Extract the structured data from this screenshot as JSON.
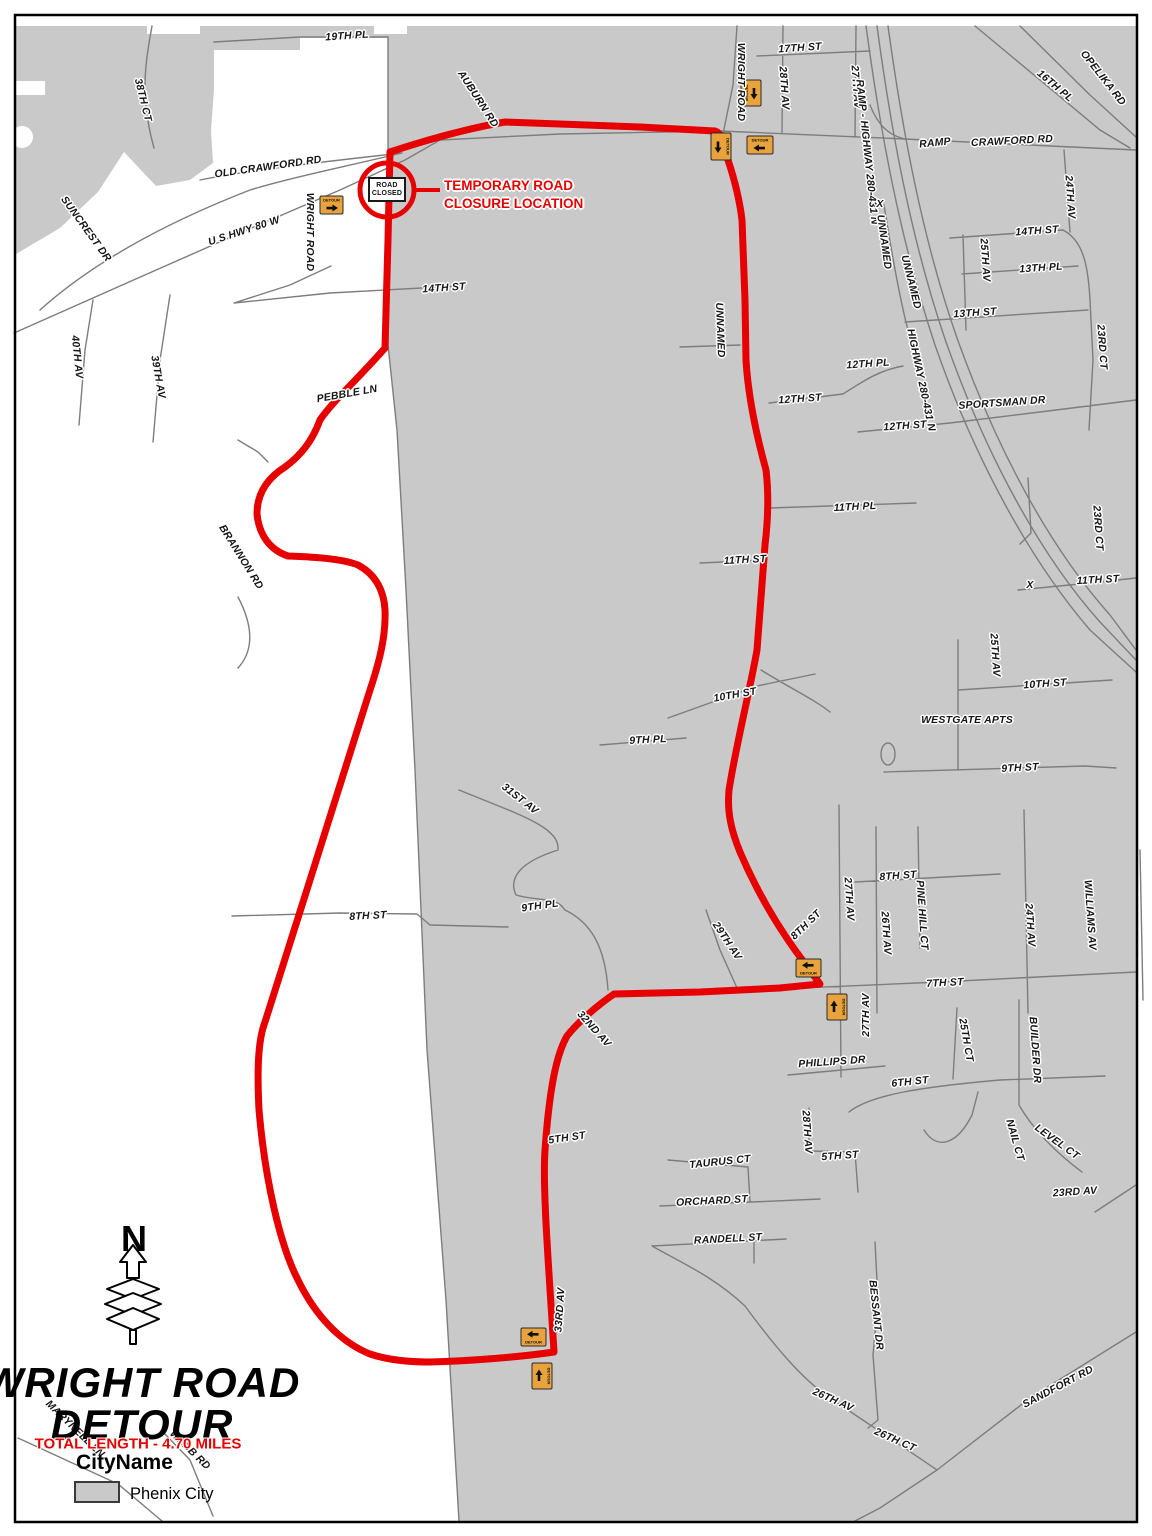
{
  "title": {
    "line1": "WRIGHT ROAD",
    "line2": "DETOUR",
    "length_note": "TOTAL LENGTH - 4.70 MILES"
  },
  "legend": {
    "heading": "CityName",
    "items": [
      {
        "label": "Phenix City",
        "swatch": "#c9c9c9"
      }
    ]
  },
  "north_label": "N",
  "closure": {
    "sign_line1": "ROAD",
    "sign_line2": "CLOSED",
    "callout_line1": "TEMPORARY ROAD",
    "callout_line2": "CLOSURE LOCATION"
  },
  "sign_label": "DETOUR",
  "colors": {
    "route_red": "#e60000",
    "city_gray": "#c9c9c9",
    "road_gray": "#7d7d7d",
    "sign_orange": "#e8a33c",
    "sign_border": "#2a2a2a"
  },
  "labels": [
    {
      "t": "19TH PL",
      "x": 347,
      "y": 36,
      "r": -4
    },
    {
      "t": "38TH CT",
      "x": 143,
      "y": 100,
      "r": 76
    },
    {
      "t": "OLD CRAWFORD RD",
      "x": 268,
      "y": 167,
      "r": -8
    },
    {
      "t": "SUNCREST DR",
      "x": 86,
      "y": 229,
      "r": 54
    },
    {
      "t": "U S HWY 80 W",
      "x": 244,
      "y": 231,
      "r": -18
    },
    {
      "t": "WRIGHT ROAD",
      "x": 310,
      "y": 232,
      "r": 90
    },
    {
      "t": "40TH AV",
      "x": 77,
      "y": 357,
      "r": 84
    },
    {
      "t": "39TH AV",
      "x": 158,
      "y": 377,
      "r": 80
    },
    {
      "t": "14TH ST",
      "x": 444,
      "y": 288,
      "r": -4
    },
    {
      "t": "PEBBLE LN",
      "x": 347,
      "y": 394,
      "r": -10
    },
    {
      "t": "BRANNON RD",
      "x": 241,
      "y": 557,
      "r": 58
    },
    {
      "t": "AUBURN RD",
      "x": 478,
      "y": 99,
      "r": 57
    },
    {
      "t": "WRIGHT ROAD",
      "x": 741,
      "y": 82,
      "r": 90
    },
    {
      "t": "17TH ST",
      "x": 800,
      "y": 48,
      "r": -4
    },
    {
      "t": "28TH AV",
      "x": 784,
      "y": 88,
      "r": 86
    },
    {
      "t": "27TH AV",
      "x": 856,
      "y": 87,
      "r": 86
    },
    {
      "t": "RAMP - HIGHWAY 280-431 N",
      "x": 867,
      "y": 152,
      "r": 84
    },
    {
      "t": "X",
      "x": 880,
      "y": 204,
      "r": 0
    },
    {
      "t": "UNNAMED",
      "x": 884,
      "y": 242,
      "r": 82
    },
    {
      "t": "UNNAMED",
      "x": 911,
      "y": 282,
      "r": 76
    },
    {
      "t": "HIGHWAY 280-431 N",
      "x": 921,
      "y": 380,
      "r": 78
    },
    {
      "t": "RAMP",
      "x": 935,
      "y": 143,
      "r": -6
    },
    {
      "t": "CRAWFORD RD",
      "x": 1012,
      "y": 141,
      "r": -3
    },
    {
      "t": "OPELIKA RD",
      "x": 1103,
      "y": 78,
      "r": 52
    },
    {
      "t": "16TH PL",
      "x": 1055,
      "y": 86,
      "r": 40
    },
    {
      "t": "24TH AV",
      "x": 1070,
      "y": 197,
      "r": 86
    },
    {
      "t": "14TH ST",
      "x": 1037,
      "y": 231,
      "r": -4
    },
    {
      "t": "25TH AV",
      "x": 985,
      "y": 260,
      "r": 86
    },
    {
      "t": "13TH PL",
      "x": 1041,
      "y": 268,
      "r": -4
    },
    {
      "t": "13TH ST",
      "x": 975,
      "y": 313,
      "r": -4
    },
    {
      "t": "23RD CT",
      "x": 1102,
      "y": 347,
      "r": 86
    },
    {
      "t": "UNNAMED",
      "x": 720,
      "y": 330,
      "r": 88
    },
    {
      "t": "12TH PL",
      "x": 868,
      "y": 364,
      "r": -4
    },
    {
      "t": "12TH ST",
      "x": 800,
      "y": 399,
      "r": -4
    },
    {
      "t": "SPORTSMAN DR",
      "x": 1002,
      "y": 403,
      "r": -4
    },
    {
      "t": "12TH ST",
      "x": 905,
      "y": 426,
      "r": -4
    },
    {
      "t": "23RD CT",
      "x": 1098,
      "y": 528,
      "r": 86
    },
    {
      "t": "11TH PL",
      "x": 855,
      "y": 507,
      "r": -3
    },
    {
      "t": "11TH ST",
      "x": 745,
      "y": 560,
      "r": -3
    },
    {
      "t": "X",
      "x": 1030,
      "y": 585,
      "r": 0
    },
    {
      "t": "11TH ST",
      "x": 1098,
      "y": 580,
      "r": -3
    },
    {
      "t": "25TH AV",
      "x": 995,
      "y": 655,
      "r": 86
    },
    {
      "t": "10TH ST",
      "x": 735,
      "y": 695,
      "r": -10
    },
    {
      "t": "10TH ST",
      "x": 1045,
      "y": 684,
      "r": -4
    },
    {
      "t": "WESTGATE APTS",
      "x": 967,
      "y": 720,
      "r": 0
    },
    {
      "t": "9TH PL",
      "x": 648,
      "y": 740,
      "r": -3
    },
    {
      "t": "9TH ST",
      "x": 1020,
      "y": 768,
      "r": -3
    },
    {
      "t": "31ST AV",
      "x": 520,
      "y": 799,
      "r": 38
    },
    {
      "t": "8TH ST",
      "x": 368,
      "y": 916,
      "r": -3
    },
    {
      "t": "9TH PL",
      "x": 540,
      "y": 906,
      "r": -8
    },
    {
      "t": "29TH AV",
      "x": 727,
      "y": 941,
      "r": 56
    },
    {
      "t": "8TH ST",
      "x": 806,
      "y": 925,
      "r": -44
    },
    {
      "t": "27TH AV",
      "x": 849,
      "y": 899,
      "r": 86
    },
    {
      "t": "8TH ST",
      "x": 898,
      "y": 876,
      "r": -4
    },
    {
      "t": "26TH AV",
      "x": 886,
      "y": 933,
      "r": 86
    },
    {
      "t": "PINE HILL CT",
      "x": 922,
      "y": 915,
      "r": 86
    },
    {
      "t": "24TH AV",
      "x": 1030,
      "y": 925,
      "r": 86
    },
    {
      "t": "WILLIAMS AV",
      "x": 1090,
      "y": 915,
      "r": 86
    },
    {
      "t": "7TH ST",
      "x": 945,
      "y": 983,
      "r": -3
    },
    {
      "t": "27TH AV",
      "x": 866,
      "y": 1015,
      "r": -90
    },
    {
      "t": "32ND AV",
      "x": 594,
      "y": 1029,
      "r": 48
    },
    {
      "t": "25TH CT",
      "x": 966,
      "y": 1040,
      "r": 80
    },
    {
      "t": "BUILDER DR",
      "x": 1035,
      "y": 1050,
      "r": 86
    },
    {
      "t": "PHILLIPS DR",
      "x": 832,
      "y": 1062,
      "r": -4
    },
    {
      "t": "6TH ST",
      "x": 910,
      "y": 1082,
      "r": -6
    },
    {
      "t": "28TH AV",
      "x": 807,
      "y": 1132,
      "r": 86
    },
    {
      "t": "5TH ST",
      "x": 840,
      "y": 1156,
      "r": -4
    },
    {
      "t": "NAIL CT",
      "x": 1015,
      "y": 1140,
      "r": 74
    },
    {
      "t": "LEVEL CT",
      "x": 1057,
      "y": 1142,
      "r": 36
    },
    {
      "t": "5TH ST",
      "x": 567,
      "y": 1138,
      "r": -8
    },
    {
      "t": "33RD AV",
      "x": 560,
      "y": 1310,
      "r": -86
    },
    {
      "t": "23RD AV",
      "x": 1075,
      "y": 1192,
      "r": -4
    },
    {
      "t": "TAURUS CT",
      "x": 720,
      "y": 1162,
      "r": -6
    },
    {
      "t": "ORCHARD ST",
      "x": 712,
      "y": 1201,
      "r": -3
    },
    {
      "t": "RANDELL ST",
      "x": 728,
      "y": 1239,
      "r": -3
    },
    {
      "t": "BESSANT DR",
      "x": 876,
      "y": 1315,
      "r": 84
    },
    {
      "t": "26TH AV",
      "x": 833,
      "y": 1400,
      "r": 24
    },
    {
      "t": "26TH CT",
      "x": 895,
      "y": 1440,
      "r": 24
    },
    {
      "t": "SANDFORT RD",
      "x": 1058,
      "y": 1387,
      "r": -28
    },
    {
      "t": "MARYNELL LN",
      "x": 75,
      "y": 1429,
      "r": 44
    },
    {
      "t": "WEBB RD",
      "x": 190,
      "y": 1450,
      "r": 44
    }
  ],
  "signs": [
    {
      "x": 320,
      "y": 196,
      "w": 23,
      "h": 18,
      "arrow": "right",
      "text_pos": "top"
    },
    {
      "x": 741,
      "y": 80,
      "w": 20,
      "h": 26,
      "arrow": "down",
      "text_pos": "left"
    },
    {
      "x": 711,
      "y": 133,
      "w": 20,
      "h": 27,
      "arrow": "down",
      "text_pos": "right"
    },
    {
      "x": 747,
      "y": 136,
      "w": 26,
      "h": 18,
      "arrow": "left",
      "text_pos": "top"
    },
    {
      "x": 796,
      "y": 959,
      "w": 25,
      "h": 18,
      "arrow": "left",
      "text_pos": "bottom"
    },
    {
      "x": 827,
      "y": 994,
      "w": 20,
      "h": 26,
      "arrow": "up",
      "text_pos": "right"
    },
    {
      "x": 521,
      "y": 1328,
      "w": 25,
      "h": 18,
      "arrow": "left",
      "text_pos": "bottom"
    },
    {
      "x": 532,
      "y": 1363,
      "w": 20,
      "h": 26,
      "arrow": "up",
      "text_pos": "right"
    }
  ]
}
